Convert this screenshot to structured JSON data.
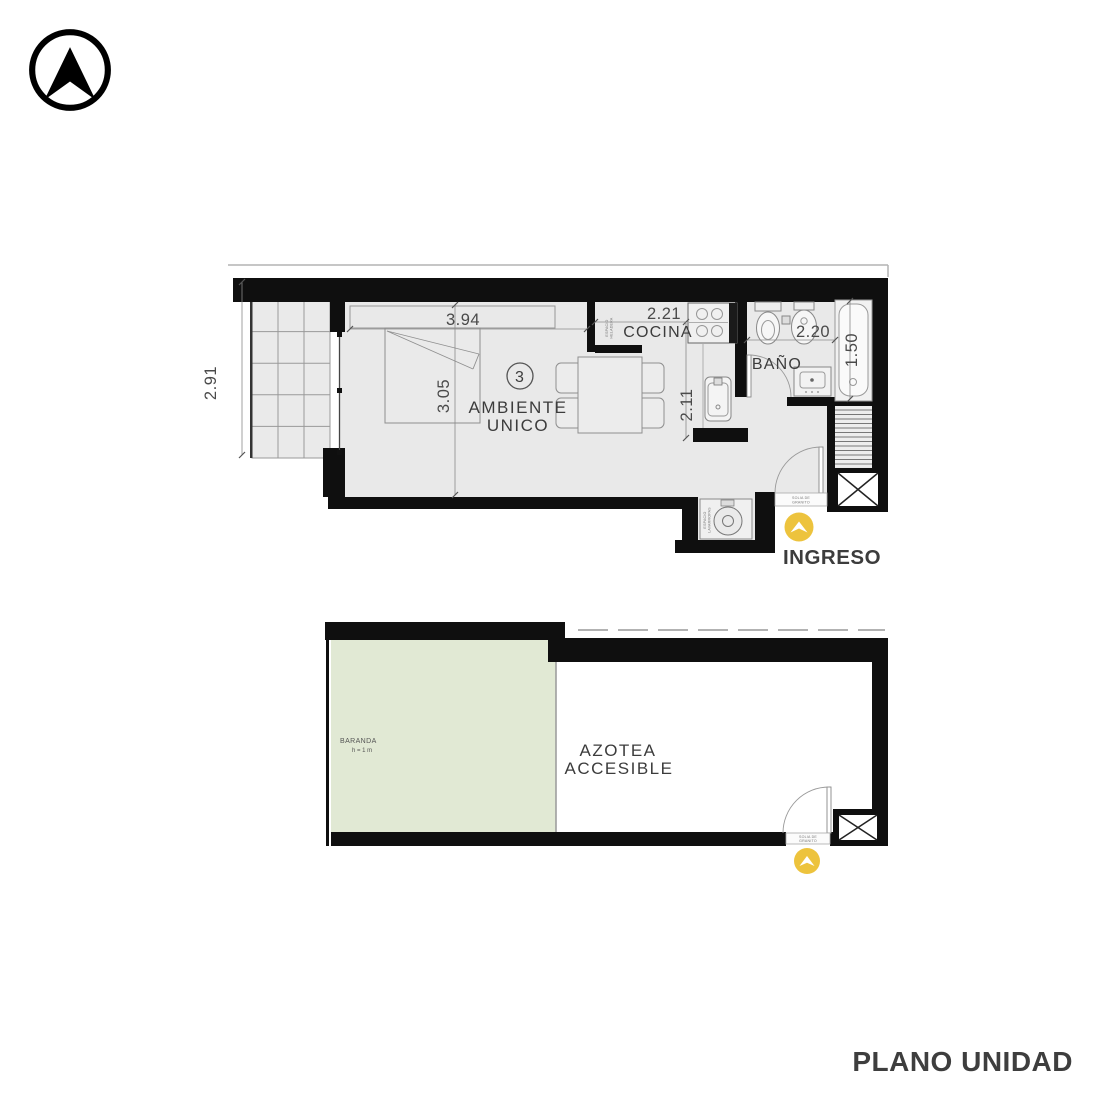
{
  "title": {
    "label": "PLANO UNIDAD"
  },
  "colors": {
    "accent_yellow": "#EDC33D",
    "wall_black": "#0f0f0f",
    "floor_gray": "#e9e9e9",
    "terrace_green": "#e1e9d4",
    "text_dark": "#3c3c3c"
  },
  "upper_plan": {
    "unit_number": "3",
    "room_labels": {
      "main_line1": "AMBIENTE",
      "main_line2": "UNICO",
      "kitchen": "COCINA",
      "bathroom": "BAÑO"
    },
    "dimensions": {
      "balcony_depth": "2.91",
      "room_width": "3.94",
      "room_depth": "3.05",
      "kitchen_width": "2.21",
      "kitchen_depth": "2.11",
      "bathroom_width": "2.20",
      "bathroom_depth": "1.50"
    },
    "small_labels": {
      "fridge_line1": "ESPACIO",
      "fridge_line2": "HELADERA",
      "laundry_line1": "ESPACIO",
      "laundry_line2": "LAVARROPAS",
      "threshold_line1": "SOLIA DE",
      "threshold_line2": "GRANITO"
    },
    "entrance_label": "INGRESO"
  },
  "lower_plan": {
    "railing_line1": "BARANDA",
    "railing_line2": "h = 1 m",
    "roof_line1": "AZOTEA",
    "roof_line2": "ACCESIBLE",
    "threshold_line1": "SOLIA DE",
    "threshold_line2": "GRANITO"
  }
}
